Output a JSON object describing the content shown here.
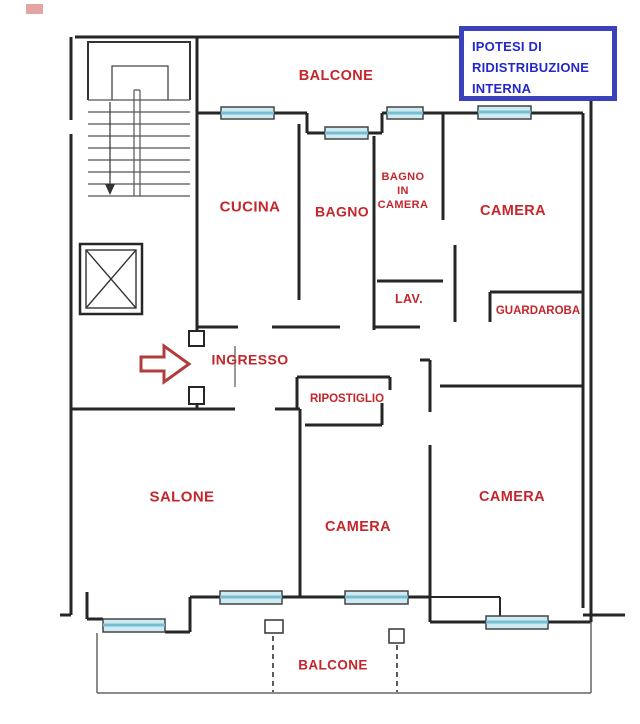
{
  "title_box": {
    "line1": "IPOTESI DI",
    "line2": "RIDISTRIBUZIONE",
    "line3": "INTERNA"
  },
  "rooms": {
    "balcone_top": "BALCONE",
    "cucina": "CUCINA",
    "bagno": "BAGNO",
    "bagno_in_camera": "BAGNO\nIN\nCAMERA",
    "camera_top_right": "CAMERA",
    "lav": "LAV.",
    "guardaroba": "GUARDAROBA",
    "ingresso": "INGRESSO",
    "ripostiglio": "RIPOSTIGLIO",
    "salone": "SALONE",
    "camera_bottom_middle": "CAMERA",
    "camera_bottom_right": "CAMERA",
    "balcone_bottom": "BALCONE"
  },
  "icons": {
    "entrance_arrow": "right-arrow",
    "stairs": "staircase-with-down-arrow",
    "elevator": "elevator-shaft-x",
    "windows": "window-markers",
    "balcony_dividers": "dashed-balcony-lines"
  },
  "colors": {
    "label_red": "#c4262b",
    "title_text_blue": "#2328c8",
    "title_border_blue": "#3a41bb",
    "wall_black": "#262626",
    "window_fill": "#cfeaf0",
    "window_stripe": "#76bdd3",
    "arrow_red": "#b23b3b"
  }
}
